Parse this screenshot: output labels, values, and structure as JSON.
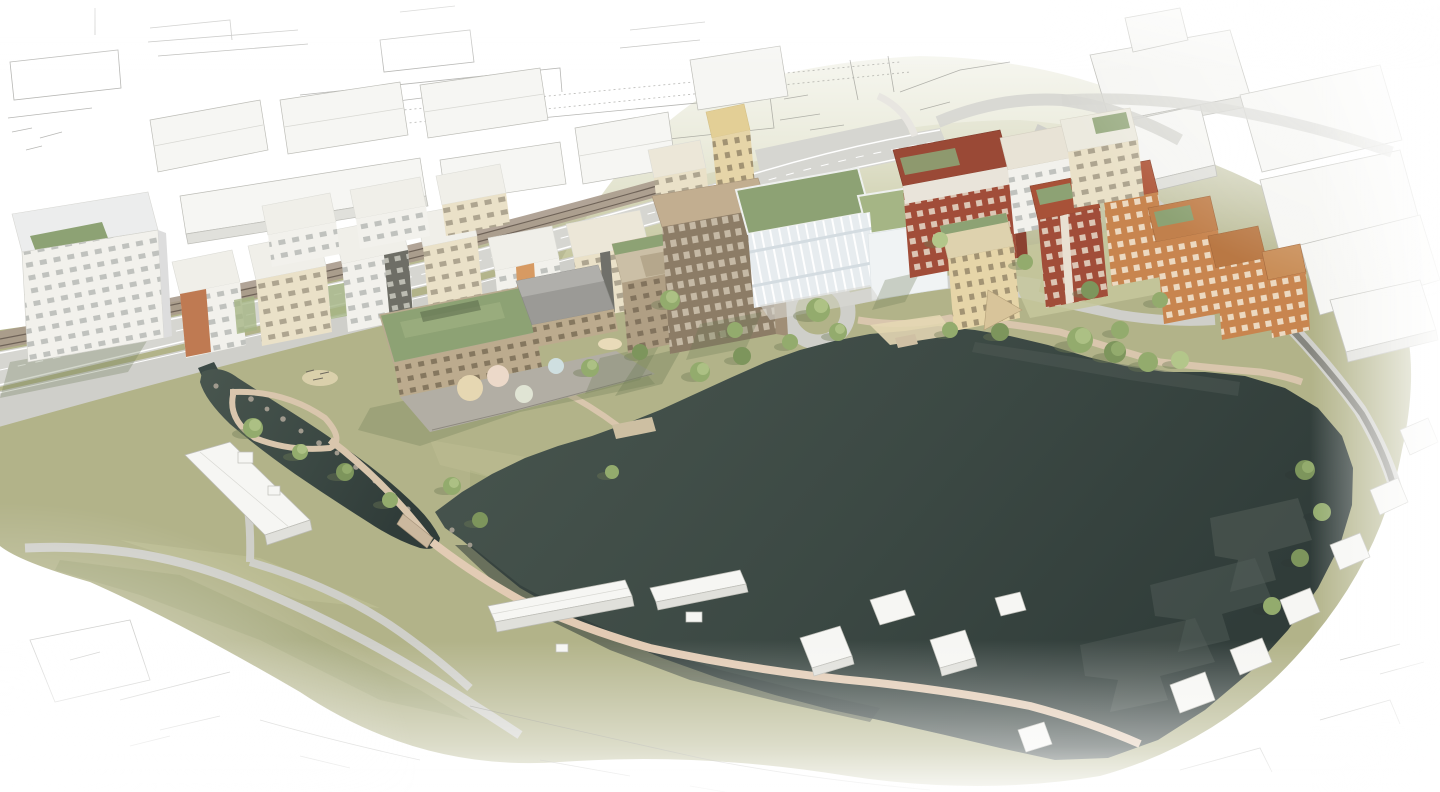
{
  "scene": {
    "type": "architectural-aerial-rendering",
    "description": "Aerial 3D visualization of a proposed lakeside masterplan: rows of white and cream apartment blocks along a road and rail corridor, a school with a large green roof and playground, a glass office building, a cluster of red and orange brick housing blocks, a dark green lake with shoreline paths, olive-green parkland, and surrounding context buildings fading into white sketch linework.",
    "elements": {
      "lake": "lake",
      "pond": "stream-pond",
      "park": "parkland",
      "hill": "south-west-hill",
      "railway": "railway-corridor",
      "highway": "main-road",
      "street": "local-street",
      "roundabout": "roundabout",
      "school": "school-with-green-roof",
      "office": "glass-office-building",
      "tower": "brown-apartment-tower",
      "brick_cluster": "brick-housing-cluster",
      "white_rows": "white-apartment-rows",
      "context": "white-context-buildings",
      "sketch": "sketch-context-linework"
    }
  },
  "palette": {
    "paper": "#ffffff",
    "sketch-line": "#7d7d78",
    "context-fill": "#f6f6f3",
    "context-shade": "#e0e0db",
    "context-line": "#bdbdb7",
    "grass-base": "#b2b389",
    "grass-light": "#c6c79c",
    "grass-dark": "#99a071",
    "grass-shadow": "#6e7a55",
    "lake-1": "#46544e",
    "lake-2": "#36423e",
    "lake-3": "#2e3936",
    "lake-shadow": "#555f5a",
    "road": "#d6d6d1",
    "road-2": "#cfcfca",
    "asphalt": "#86867f",
    "rail-bed": "#a89a8c",
    "rail-line": "#6f6358",
    "path-gray": "#cfcfc9",
    "path-tan": "#d9c6ad",
    "path-pink": "#e2cbb4",
    "sand": "#e4d7b4",
    "roof-green": "#8da274",
    "roof-green-light": "#a5b585",
    "roof-gray": "#9b9a96",
    "facade-white": "#f2f1ec",
    "facade-cream": "#eae1c8",
    "facade-tan": "#bcab8e",
    "facade-brown": "#8c7c66",
    "brick-red": "#a14d39",
    "brick-orange": "#c8854f",
    "facade-yellow": "#e6d5a8",
    "glass": "#e7ecef",
    "tree-green": "#93ab6d",
    "tree-light": "#b3c68a",
    "stone": "#a09a8e"
  }
}
